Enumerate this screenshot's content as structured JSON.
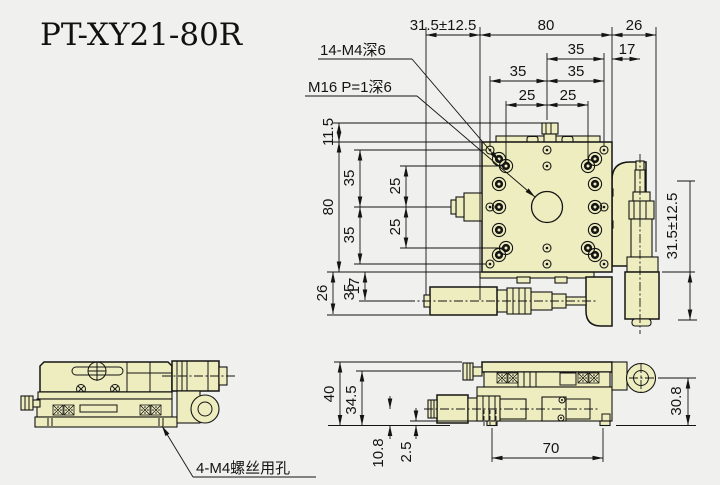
{
  "title": "PT-XY21-80R",
  "callouts": {
    "top_holes": "14-M4深6",
    "center_hole": "M16 P=1深6",
    "base_holes": "4-M4螺丝用孔"
  },
  "plan_view": {
    "top_chain": [
      "31.5±12.5",
      "80",
      "26"
    ],
    "row_35_17": [
      "35",
      "17"
    ],
    "row_35_35": [
      "35",
      "35"
    ],
    "row_25_25": [
      "25",
      "25"
    ],
    "left_chain": [
      "11.5",
      "35",
      "35",
      "25",
      "80",
      "25",
      "35",
      "26",
      "17"
    ],
    "right_travel": "31.5±12.5"
  },
  "side_view_right": {
    "height_chain": [
      "40",
      "34.5",
      "10.8",
      "2.5"
    ],
    "base_span": "70",
    "pivot_height": "30.8"
  },
  "colors": {
    "part_fill": "#eeedbf",
    "background": "#f0f0ee",
    "line": "#141414"
  }
}
